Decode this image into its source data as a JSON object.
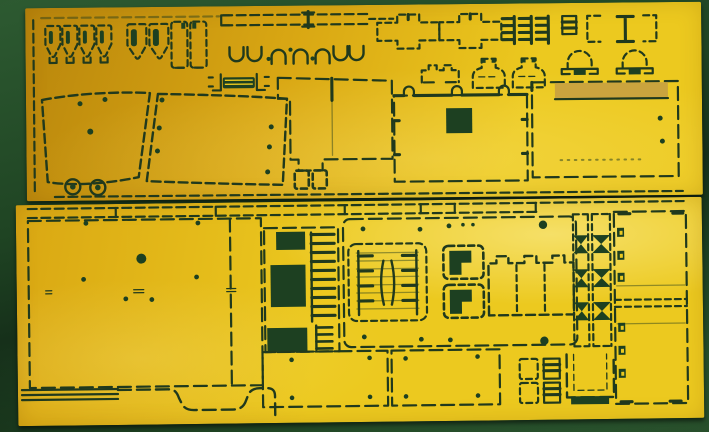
{
  "scene": {
    "description": "Photograph of two brass photo-etched detail frets for a scale model kit lying on a dark green mat; parts are outlined by dark etched cut lines with tab bridges, round bolt holes and rectangular through-openings",
    "colors": {
      "mat-deep": "#16301a",
      "mat": "#1f4423",
      "mat-light": "#2d5a31",
      "brass-deep": "#b9860c",
      "brass": "#d9a713",
      "brass-bright": "#ecc91f",
      "etch": "#20391d",
      "hole": "#1d4021",
      "half-etch": "#c7a041"
    }
  },
  "sheets": {
    "top": {
      "label": "Upper photo-etch fret: headlight guards, vision ports, hinge strip, cross brackets, grille combs, clamps, mushroom vents, fenders, hatch panel and skirt panel",
      "parts": [
        "headlight-guard-set",
        "armored-shield-pair",
        "vision-port-covers",
        "hinge-strip-long",
        "cross-bracket-pair",
        "intake-grille-combs",
        "small-grille",
        "i-beam-bracket-set",
        "clamp-row",
        "mushroom-vent-pair",
        "hinge-bar",
        "bumper-bracket",
        "bell-mount-pair",
        "fender-panel-left",
        "fender-panel-right",
        "grommet-discs",
        "stepped-hull-panel",
        "port-frame-pair",
        "hatch-panel",
        "skirt-panel"
      ]
    },
    "bottom": {
      "label": "Lower photo-etch fret: hull floor panel, radiator comb, engine deck with louver grilles and battery box, track guard strips, side hull panel, floor plates and brackets",
      "parts": [
        "top-rail-strips",
        "hull-floor-panel",
        "radiator-comb-panel",
        "engine-deck-panel",
        "louver-grille-pair",
        "l-port-frames",
        "battery-box-panel",
        "track-guard-strips",
        "side-hull-panel",
        "floor-plate-pair",
        "stowage-strips",
        "wheel-arch-profile",
        "latch-blocks",
        "u-channel-bracket"
      ]
    }
  }
}
